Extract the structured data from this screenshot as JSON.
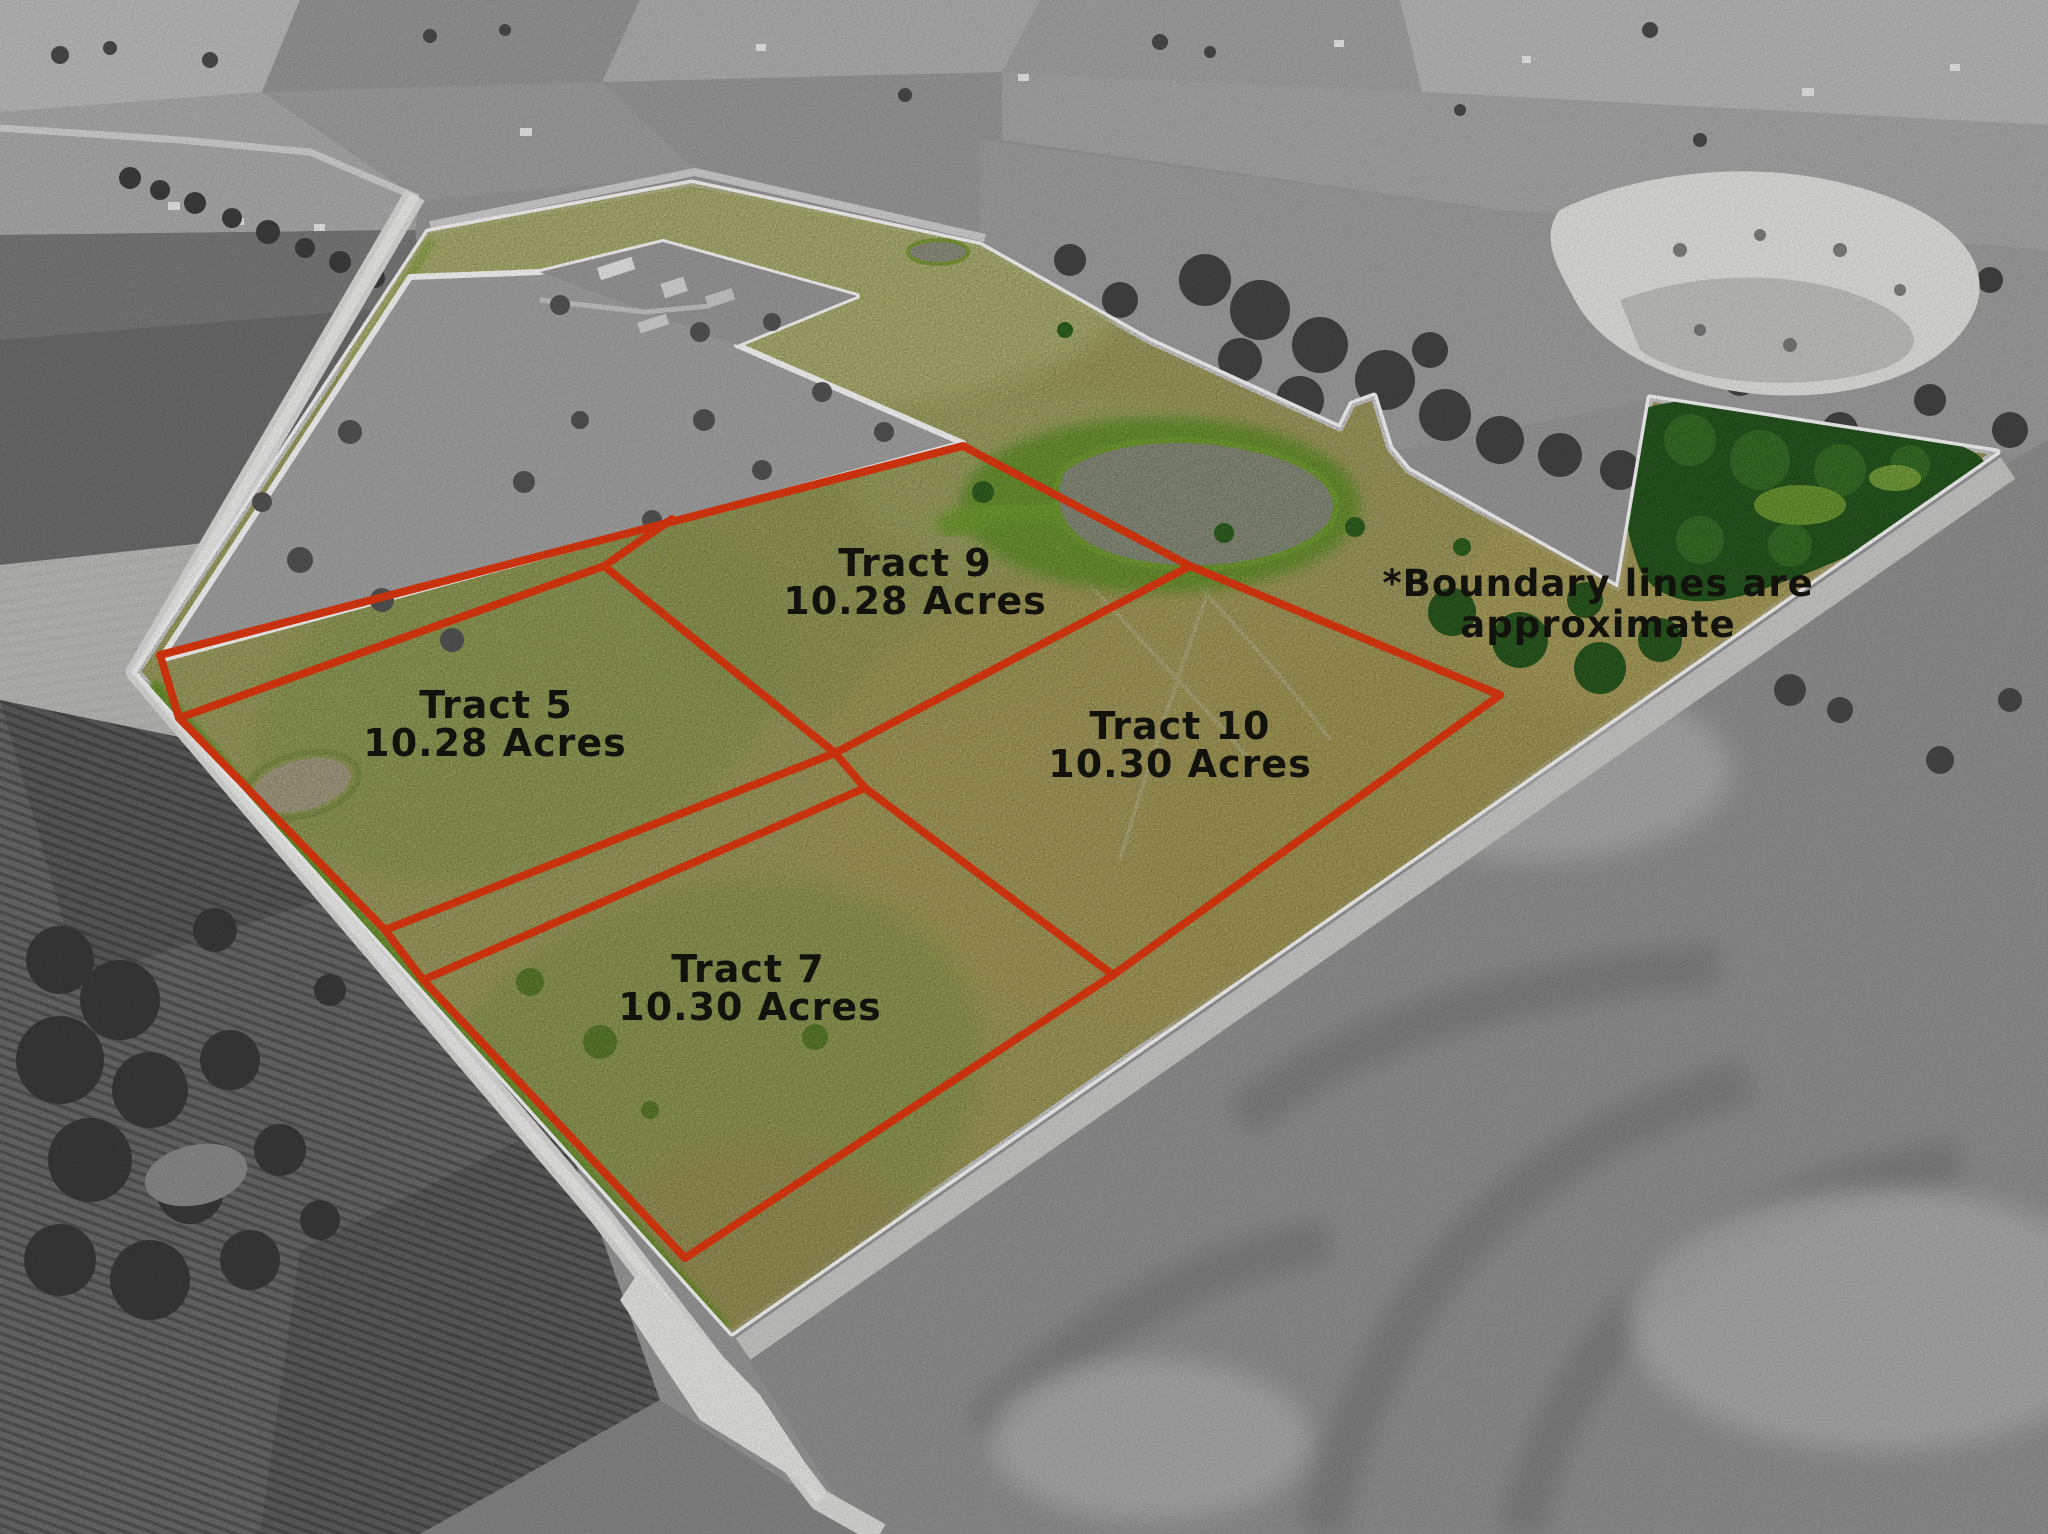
{
  "map": {
    "type": "aerial-property-tract-map",
    "description": "Aerial photo with highlighted farmland property divided into labeled tracts"
  },
  "tracts": [
    {
      "name": "Tract 5",
      "acres": "10.28 Acres"
    },
    {
      "name": "Tract 7",
      "acres": "10.30 Acres"
    },
    {
      "name": "Tract 9",
      "acres": "10.28 Acres"
    },
    {
      "name": "Tract 10",
      "acres": "10.30 Acres"
    }
  ],
  "disclaimer": {
    "line1": "*Boundary lines are",
    "line2": "approximate"
  },
  "colors": {
    "tract_line_red": "#e63a10",
    "boundary_white": "#ffffff",
    "label_text": "#16160f",
    "highlight_grass": "#c3c574",
    "surrounding_gray": "#9a9a9a"
  }
}
